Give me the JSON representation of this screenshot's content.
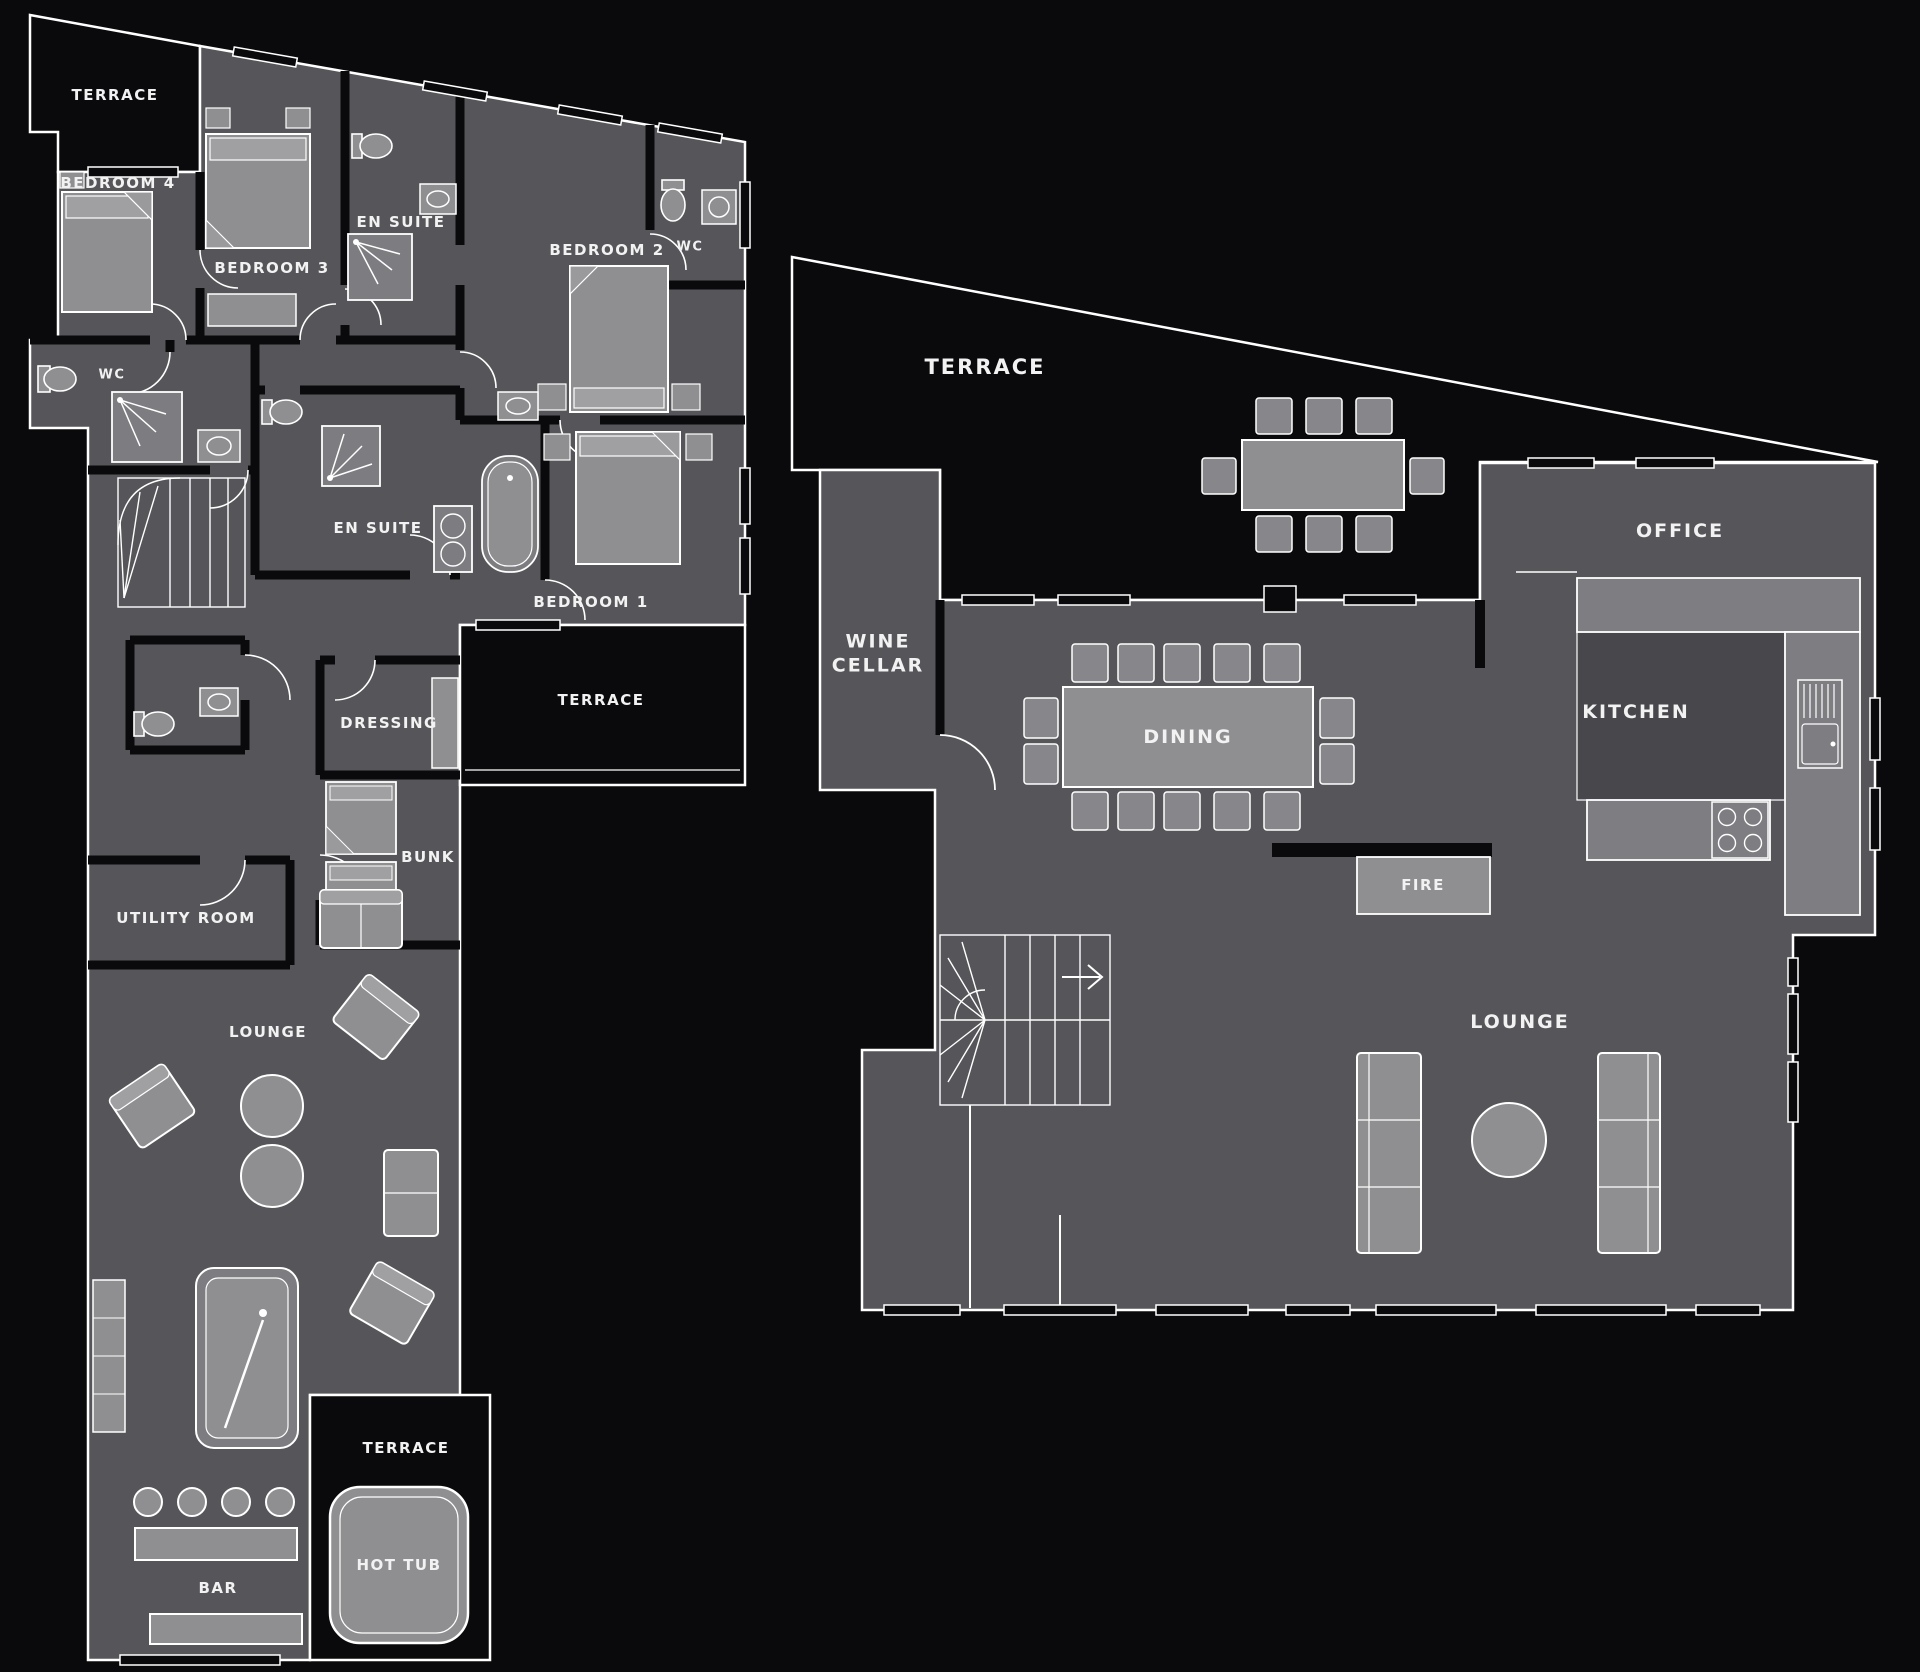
{
  "colors": {
    "background": "#0a0a0c",
    "floor": "#56565a",
    "floor_dark": "#47474c",
    "furniture": "#8f8f92",
    "furniture_secondary": "#7d7d81",
    "counter": "#7e7e82",
    "outline": "#ffffff",
    "label_text": "#f2f2f3"
  },
  "left_plan": {
    "name": "bedroom-level-floor-plan",
    "labels": {
      "terrace_top": "TERRACE",
      "bedroom4": "BEDROOM 4",
      "bedroom3": "BEDROOM 3",
      "ensuite_top": "EN SUITE",
      "bedroom2": "BEDROOM 2",
      "wc_top": "WC",
      "wc_left": "WC",
      "ensuite_mid": "EN SUITE",
      "bedroom1": "BEDROOM 1",
      "terrace_mid": "TERRACE",
      "dressing": "DRESSING",
      "bunk": "BUNK",
      "utility_room": "UTILITY ROOM",
      "lounge": "LOUNGE",
      "bar": "BAR",
      "terrace_bottom": "TERRACE",
      "hot_tub": "HOT TUB"
    }
  },
  "right_plan": {
    "name": "living-level-floor-plan",
    "labels": {
      "terrace": "TERRACE",
      "wine_cellar": "WINE CELLAR",
      "dining": "DINING",
      "office": "OFFICE",
      "kitchen": "KITCHEN",
      "fire": "FIRE",
      "lounge": "LOUNGE"
    }
  }
}
